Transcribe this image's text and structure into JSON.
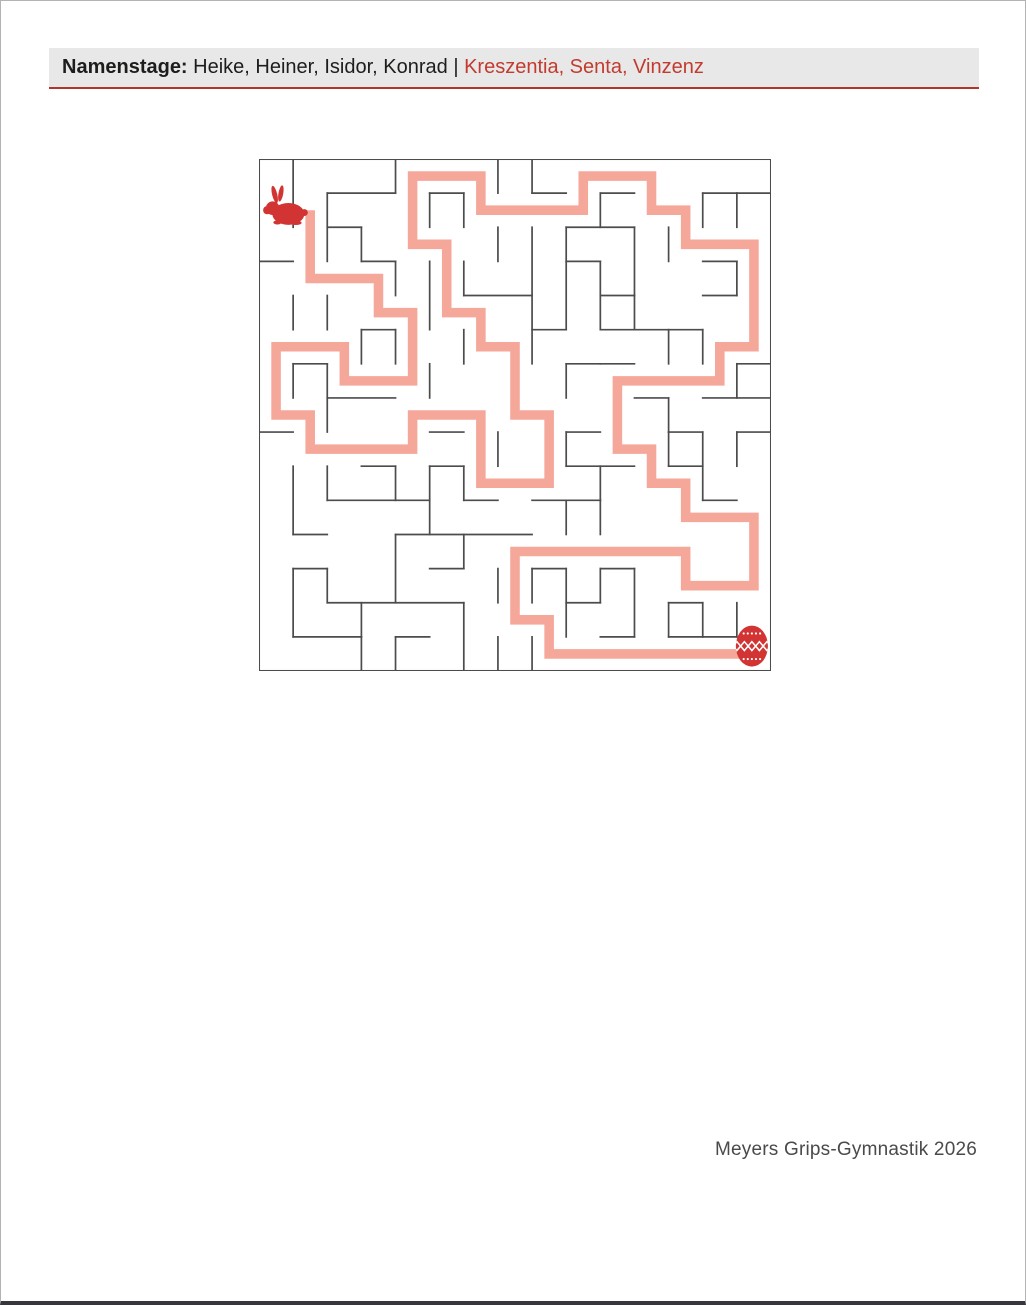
{
  "header": {
    "label": "Namenstage:",
    "names_black": " Heike, Heiner, Isidor, Konrad ",
    "separator": "|",
    "names_red": " Kreszentia, Senta, Vinzenz",
    "bar_color": "#e8e8e8",
    "red_color": "#c23b2e",
    "rule_color": "#ae372b"
  },
  "footer": {
    "credit": "Meyers Grips-Gymnastik 2026"
  },
  "maze": {
    "grid_size": 15,
    "wall_color": "#4c4c4c",
    "path_color": "#f5a79a",
    "icon_color": "#d23434",
    "start_icon": "easter-bunny",
    "end_icon": "easter-egg",
    "start_cell": [
      0,
      1
    ],
    "end_cell": [
      14,
      14
    ],
    "walls": [
      [
        1,
        0,
        1,
        2
      ],
      [
        2,
        1,
        2,
        3
      ],
      [
        3,
        2,
        3,
        3
      ],
      [
        4,
        0,
        4,
        1
      ],
      [
        4,
        3,
        4,
        4
      ],
      [
        5,
        1,
        5,
        2
      ],
      [
        5,
        3,
        5,
        5
      ],
      [
        6,
        1,
        6,
        2
      ],
      [
        6,
        3,
        6,
        4
      ],
      [
        6,
        5,
        6,
        6
      ],
      [
        7,
        0,
        7,
        1
      ],
      [
        8,
        0,
        8,
        1
      ],
      [
        7,
        2,
        7,
        3
      ],
      [
        8,
        2,
        8,
        6
      ],
      [
        1,
        4,
        1,
        5
      ],
      [
        2,
        4,
        2,
        5
      ],
      [
        3,
        5,
        3,
        6
      ],
      [
        4,
        5,
        4,
        6
      ],
      [
        1,
        6,
        1,
        7
      ],
      [
        2,
        6,
        2,
        8
      ],
      [
        5,
        6,
        5,
        7
      ],
      [
        9,
        2,
        9,
        5
      ],
      [
        10,
        1,
        10,
        2
      ],
      [
        10,
        3,
        10,
        5
      ],
      [
        11,
        2,
        11,
        4
      ],
      [
        12,
        2,
        12,
        3
      ],
      [
        13,
        1,
        13,
        2
      ],
      [
        14,
        1,
        14,
        2
      ],
      [
        14,
        3,
        14,
        4
      ],
      [
        11,
        4,
        11,
        5
      ],
      [
        12,
        5,
        12,
        6
      ],
      [
        13,
        5,
        13,
        6
      ],
      [
        9,
        6,
        9,
        7
      ],
      [
        14,
        6,
        14,
        7
      ],
      [
        7,
        8,
        7,
        9
      ],
      [
        5,
        9,
        5,
        10
      ],
      [
        1,
        9,
        1,
        11
      ],
      [
        2,
        9,
        2,
        10
      ],
      [
        4,
        9,
        4,
        10
      ],
      [
        6,
        9,
        6,
        10
      ],
      [
        9,
        8,
        9,
        9
      ],
      [
        10,
        9,
        10,
        10
      ],
      [
        12,
        8,
        12,
        9
      ],
      [
        13,
        8,
        13,
        10
      ],
      [
        14,
        8,
        14,
        9
      ],
      [
        9,
        10,
        9,
        11
      ],
      [
        10,
        10,
        10,
        11
      ],
      [
        5,
        10,
        5,
        11
      ],
      [
        2,
        12,
        2,
        13
      ],
      [
        1,
        12,
        1,
        14
      ],
      [
        6,
        11,
        6,
        12
      ],
      [
        4,
        11,
        4,
        13
      ],
      [
        7,
        12,
        7,
        13
      ],
      [
        8,
        12,
        8,
        13
      ],
      [
        9,
        12,
        9,
        14
      ],
      [
        10,
        12,
        10,
        13
      ],
      [
        11,
        12,
        11,
        14
      ],
      [
        12,
        13,
        12,
        14
      ],
      [
        13,
        13,
        13,
        14
      ],
      [
        14,
        13,
        14,
        14
      ],
      [
        3,
        13,
        3,
        14
      ],
      [
        3,
        14,
        3,
        15
      ],
      [
        4,
        14,
        4,
        15
      ],
      [
        6,
        13,
        6,
        15
      ],
      [
        7,
        14,
        7,
        15
      ],
      [
        8,
        14,
        8,
        15
      ],
      [
        12,
        7,
        12,
        8
      ],
      [
        2,
        1,
        4,
        1
      ],
      [
        5,
        1,
        6,
        1
      ],
      [
        8,
        1,
        9,
        1
      ],
      [
        10,
        1,
        11,
        1
      ],
      [
        13,
        1,
        14,
        1
      ],
      [
        14,
        1,
        15,
        1
      ],
      [
        2,
        2,
        3,
        2
      ],
      [
        9,
        2,
        11,
        2
      ],
      [
        0,
        3,
        1,
        3
      ],
      [
        3,
        3,
        4,
        3
      ],
      [
        9,
        3,
        10,
        3
      ],
      [
        13,
        3,
        14,
        3
      ],
      [
        6,
        4,
        8,
        4
      ],
      [
        10,
        4,
        11,
        4
      ],
      [
        13,
        4,
        14,
        4
      ],
      [
        3,
        5,
        4,
        5
      ],
      [
        8,
        5,
        9,
        5
      ],
      [
        10,
        5,
        13,
        5
      ],
      [
        1,
        6,
        2,
        6
      ],
      [
        9,
        6,
        10,
        6
      ],
      [
        10,
        6,
        11,
        6
      ],
      [
        14,
        6,
        15,
        6
      ],
      [
        2,
        7,
        4,
        7
      ],
      [
        11,
        7,
        12,
        7
      ],
      [
        13,
        7,
        15,
        7
      ],
      [
        0,
        8,
        1,
        8
      ],
      [
        5,
        8,
        6,
        8
      ],
      [
        9,
        8,
        10,
        8
      ],
      [
        12,
        8,
        13,
        8
      ],
      [
        14,
        8,
        15,
        8
      ],
      [
        3,
        9,
        4,
        9
      ],
      [
        5,
        9,
        6,
        9
      ],
      [
        9,
        9,
        11,
        9
      ],
      [
        12,
        9,
        13,
        9
      ],
      [
        2,
        10,
        5,
        10
      ],
      [
        6,
        10,
        7,
        10
      ],
      [
        8,
        10,
        10,
        10
      ],
      [
        13,
        10,
        14,
        10
      ],
      [
        1,
        11,
        2,
        11
      ],
      [
        4,
        11,
        8,
        11
      ],
      [
        1,
        12,
        2,
        12
      ],
      [
        5,
        12,
        6,
        12
      ],
      [
        8,
        12,
        9,
        12
      ],
      [
        10,
        12,
        11,
        12
      ],
      [
        2,
        13,
        6,
        13
      ],
      [
        9,
        13,
        10,
        13
      ],
      [
        12,
        13,
        13,
        13
      ],
      [
        1,
        14,
        3,
        14
      ],
      [
        4,
        14,
        5,
        14
      ],
      [
        10,
        14,
        11,
        14
      ],
      [
        12,
        14,
        13,
        14
      ],
      [
        13,
        14,
        14,
        14
      ]
    ],
    "solution_path": [
      [
        1.5,
        1.5
      ],
      [
        1.5,
        3.5
      ],
      [
        3.5,
        3.5
      ],
      [
        3.5,
        4.5
      ],
      [
        4.5,
        4.5
      ],
      [
        4.5,
        6.5
      ],
      [
        2.5,
        6.5
      ],
      [
        2.5,
        5.5
      ],
      [
        0.5,
        5.5
      ],
      [
        0.5,
        7.5
      ],
      [
        1.5,
        7.5
      ],
      [
        1.5,
        8.5
      ],
      [
        4.5,
        8.5
      ],
      [
        4.5,
        7.5
      ],
      [
        6.5,
        7.5
      ],
      [
        6.5,
        9.5
      ],
      [
        8.5,
        9.5
      ],
      [
        8.5,
        7.5
      ],
      [
        7.5,
        7.5
      ],
      [
        7.5,
        5.5
      ],
      [
        6.5,
        5.5
      ],
      [
        6.5,
        4.5
      ],
      [
        5.5,
        4.5
      ],
      [
        5.5,
        2.5
      ],
      [
        4.5,
        2.5
      ],
      [
        4.5,
        0.5
      ],
      [
        6.5,
        0.5
      ],
      [
        6.5,
        1.5
      ],
      [
        9.5,
        1.5
      ],
      [
        9.5,
        0.5
      ],
      [
        11.5,
        0.5
      ],
      [
        11.5,
        1.5
      ],
      [
        12.5,
        1.5
      ],
      [
        12.5,
        2.5
      ],
      [
        14.5,
        2.5
      ],
      [
        14.5,
        5.5
      ],
      [
        13.5,
        5.5
      ],
      [
        13.5,
        6.5
      ],
      [
        10.5,
        6.5
      ],
      [
        10.5,
        8.5
      ],
      [
        11.5,
        8.5
      ],
      [
        11.5,
        9.5
      ],
      [
        12.5,
        9.5
      ],
      [
        12.5,
        10.5
      ],
      [
        14.5,
        10.5
      ],
      [
        14.5,
        12.5
      ],
      [
        12.5,
        12.5
      ],
      [
        12.5,
        11.5
      ],
      [
        7.5,
        11.5
      ],
      [
        7.5,
        13.5
      ],
      [
        8.5,
        13.5
      ],
      [
        8.5,
        14.5
      ],
      [
        14.5,
        14.5
      ]
    ]
  }
}
